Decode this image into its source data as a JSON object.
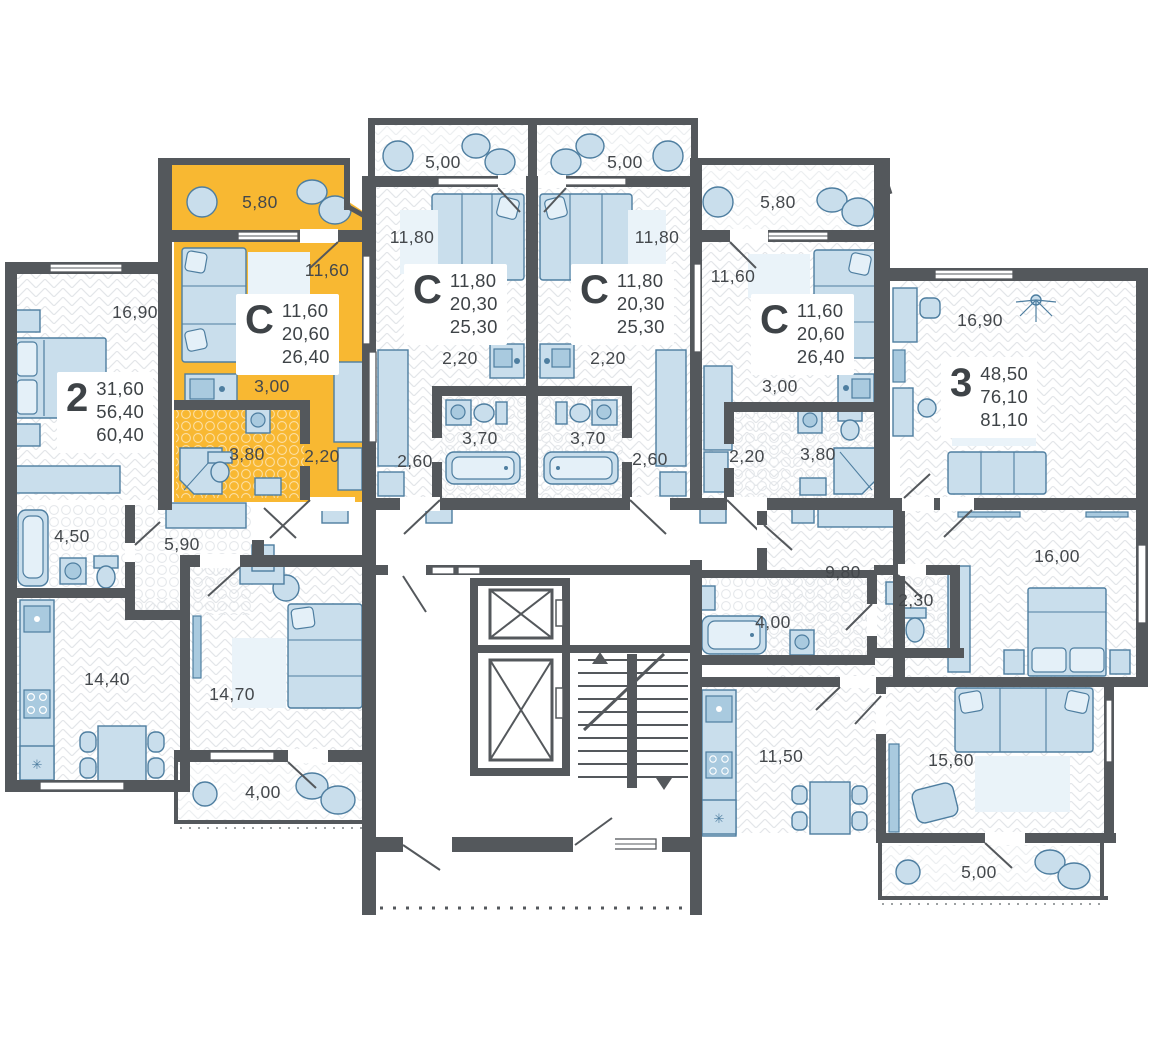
{
  "plan": {
    "colors": {
      "highlight": "#F8B832",
      "wall": "#54585C",
      "furniture_fill": "#C9DEEC",
      "furniture_stroke": "#4E7EA0",
      "label_text": "#44484C",
      "background": "#FFFFFF"
    },
    "apartments": [
      {
        "id": "2-room",
        "type_label": "2",
        "highlighted": false,
        "areas": [
          "31,60",
          "56,40",
          "60,40"
        ],
        "rooms": [
          "16,90",
          "4,50",
          "5,90",
          "14,40",
          "14,70",
          "4,00"
        ]
      },
      {
        "id": "studio-highlighted",
        "type_label": "С",
        "highlighted": true,
        "areas": [
          "11,60",
          "20,60",
          "26,40"
        ],
        "rooms": [
          "5,80",
          "11,60",
          "3,00",
          "3,80",
          "2,20"
        ]
      },
      {
        "id": "studio-mid-left",
        "type_label": "С",
        "highlighted": false,
        "areas": [
          "11,80",
          "20,30",
          "25,30"
        ],
        "rooms": [
          "5,00",
          "11,80",
          "2,20",
          "3,70",
          "2,60"
        ]
      },
      {
        "id": "studio-mid-right",
        "type_label": "С",
        "highlighted": false,
        "areas": [
          "11,80",
          "20,30",
          "25,30"
        ],
        "rooms": [
          "5,00",
          "11,80",
          "2,20",
          "3,70",
          "2,60"
        ]
      },
      {
        "id": "studio-right",
        "type_label": "С",
        "highlighted": false,
        "areas": [
          "11,60",
          "20,60",
          "26,40"
        ],
        "rooms": [
          "5,80",
          "11,60",
          "3,00",
          "2,20",
          "3,80"
        ]
      },
      {
        "id": "3-room",
        "type_label": "3",
        "highlighted": false,
        "areas": [
          "48,50",
          "76,10",
          "81,10"
        ],
        "rooms": [
          "16,90",
          "16,00",
          "9,80",
          "2,30",
          "4,00",
          "11,50",
          "15,60",
          "5,00"
        ]
      }
    ]
  }
}
